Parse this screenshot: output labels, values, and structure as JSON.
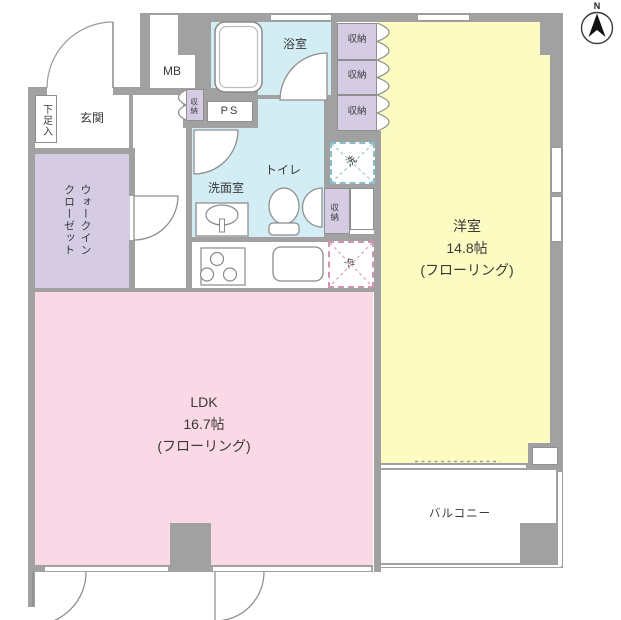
{
  "plan": {
    "title": "apartment-floor-plan",
    "compass": {
      "label": "N"
    },
    "rooms": {
      "entrance": {
        "label": "玄関"
      },
      "shoe_cabinet": {
        "label": "下足入"
      },
      "meter_box": {
        "label": "MB"
      },
      "pipe_space": {
        "label": "PS"
      },
      "hall_storage": {
        "label": "収納"
      },
      "bathroom": {
        "label": "浴室"
      },
      "toilet": {
        "label": "トイレ"
      },
      "washroom": {
        "label": "洗面室"
      },
      "walk_in_closet": {
        "label": "ウォークイン\nクローゼット"
      },
      "storage_top_1": {
        "label": "収納"
      },
      "storage_top_2": {
        "label": "収納"
      },
      "storage_top_3": {
        "label": "収納"
      },
      "mid_storage": {
        "label": "収納"
      },
      "washer": {
        "label": "洗"
      },
      "fridge": {
        "label": "冷"
      },
      "western_room": {
        "name": "洋室",
        "size": "14.8帖",
        "floor_type": "(フローリング)"
      },
      "ldk": {
        "name": "LDK",
        "size": "16.7帖",
        "floor_type": "(フローリング)"
      },
      "balcony": {
        "label": "バルコニー"
      }
    },
    "colors": {
      "wall": "#a1a1a1",
      "wet_area_cyan": "#d2edf4",
      "storage_purple": "#d5cce4",
      "ldk_pink": "#fbd8e6",
      "western_yellow": "#fcfbc1",
      "washer_accent": "#85bfcd",
      "fridge_accent": "#d492b4",
      "line": "#8a8a8a"
    }
  }
}
